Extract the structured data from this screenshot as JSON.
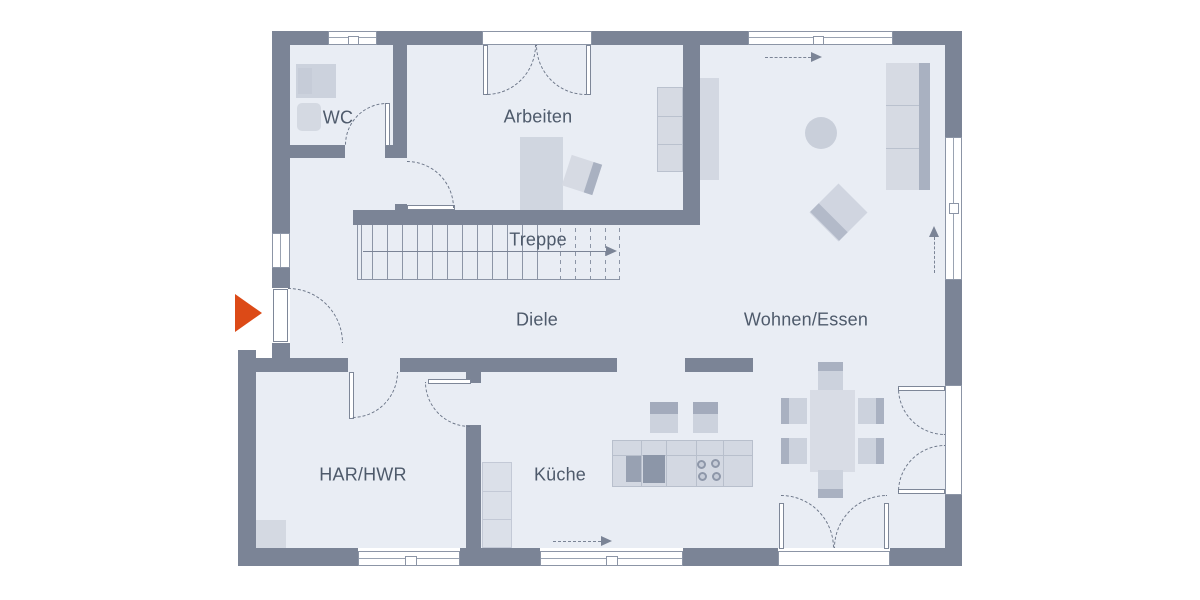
{
  "plan": {
    "type": "floor-plan",
    "rooms": {
      "wc": "WC",
      "arbeiten": "Arbeiten",
      "treppe": "Treppe",
      "diele": "Diele",
      "wohnen_essen": "Wohnen/Essen",
      "har_hwr": "HAR/HWR",
      "kueche": "Küche"
    },
    "icons": [
      {
        "name": "entrance-arrow",
        "shape": "triangle-right",
        "color": "#dc4a17"
      },
      {
        "name": "stair-direction-arrow",
        "shape": "line-arrow-right",
        "color": "#7b8496"
      },
      {
        "name": "window-direction-arrow-top",
        "shape": "dashed-arrow-right",
        "color": "#7b8496"
      },
      {
        "name": "window-direction-arrow-right",
        "shape": "dashed-arrow-up",
        "color": "#7b8496"
      },
      {
        "name": "window-direction-arrow-bottom",
        "shape": "dashed-arrow-right",
        "color": "#7b8496"
      }
    ],
    "colors": {
      "wall": "#7b8496",
      "floor": "#e9edf4",
      "accent": "#dc4a17",
      "line": "#8c95a6",
      "text": "#4e5a6b",
      "furniture_light": "#d4d9e2",
      "furniture_dark": "#a9b1c1",
      "background": "#ffffff"
    }
  }
}
